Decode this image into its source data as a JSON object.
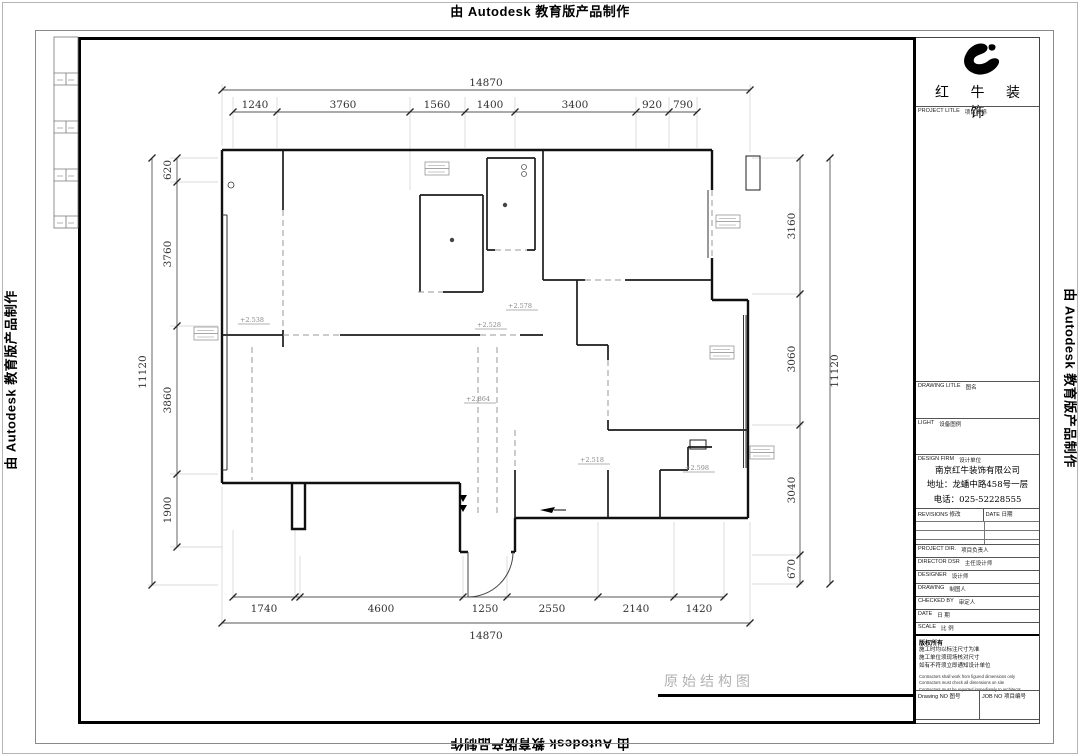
{
  "stamp": {
    "text": "由 Autodesk 教育版产品制作"
  },
  "plan": {
    "title": "原始结构图",
    "dims": {
      "top_total": "14870",
      "top_segments": [
        "1240",
        "3760",
        "1560",
        "1400",
        "3400",
        "920",
        "790"
      ],
      "bottom_total": "14870",
      "bottom_segments": [
        "1740",
        "4600",
        "1250",
        "2550",
        "2140",
        "1420"
      ],
      "left_total": "11120",
      "left_segments": [
        "620",
        "3760",
        "3860",
        "1900"
      ],
      "right_total": "11120",
      "right_segments": [
        "3160",
        "3060",
        "3040",
        "670"
      ]
    },
    "elevations": [
      "+2.538",
      "+2.578",
      "+2.528",
      "+2.864",
      "+2.518",
      "+2.598"
    ]
  },
  "titleblock": {
    "brand": "红 牛 装 饰",
    "project_title": {
      "en": "PROJECT LITLE",
      "cn": "项目名称"
    },
    "drawing_title": {
      "en": "DRAWING LITLE",
      "cn": "图名"
    },
    "light": {
      "en": "LIGHT",
      "cn": "设备图例"
    },
    "design_firm": {
      "en": "DESIGN FIRM",
      "cn": "设计单位"
    },
    "company": {
      "name": "南京红牛装饰有限公司",
      "address": "地址：龙蟠中路458号一层",
      "phone": "电话：025-52228555"
    },
    "revisions": {
      "en": "REVISIONS",
      "cn": "修改"
    },
    "rev_date": {
      "en": "DATE",
      "cn": "日期"
    },
    "staff": [
      {
        "en": "PROJECT DIR.",
        "cn": "项目负责人"
      },
      {
        "en": "DIRECTOR DSR",
        "cn": "主任设计师"
      },
      {
        "en": "DESIGNER",
        "cn": "设计师"
      },
      {
        "en": "DRAWING",
        "cn": "制图人"
      },
      {
        "en": "CHECKED BY",
        "cn": "审定人"
      },
      {
        "en": "DATE",
        "cn": "日  期"
      },
      {
        "en": "SCALE",
        "cn": "比  例"
      }
    ],
    "copyright": "版权所有",
    "notes_cn": [
      "施工时均以标注尺寸为准",
      "施工单位须现场核对尺寸",
      "如有不符须立即通知设计单位"
    ],
    "notes_en": [
      "Contractors shall work from figured dimensions only",
      "Contractors must check all dimensions on site",
      "Contractors must be reported immediately to architects"
    ],
    "drawing_no": {
      "en": "Drawing NO",
      "cn": "图号"
    },
    "job_no": {
      "en": "JOB NO",
      "cn": "项目编号"
    }
  }
}
